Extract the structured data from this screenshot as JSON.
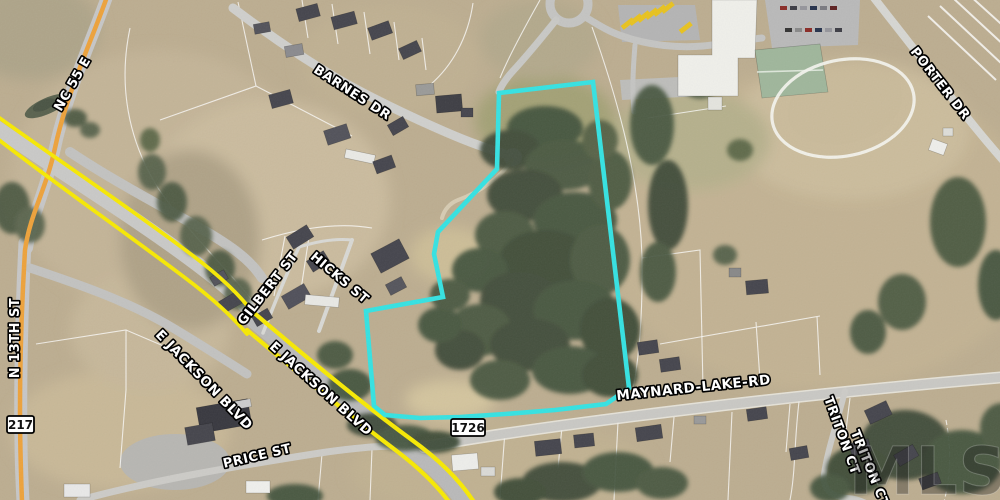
{
  "map": {
    "watermark": "MLS",
    "street_labels": [
      {
        "id": "nc-55-e",
        "text": "NC 55 E"
      },
      {
        "id": "barnes-dr",
        "text": "BARNES DR"
      },
      {
        "id": "porter-dr",
        "text": "PORTER DR"
      },
      {
        "id": "n-13th-st",
        "text": "N 13TH ST"
      },
      {
        "id": "gilbert-st",
        "text": "GILBERT ST"
      },
      {
        "id": "hicks-st",
        "text": "HICKS ST"
      },
      {
        "id": "e-jackson-blvd-1",
        "text": "E JACKSON BLVD"
      },
      {
        "id": "e-jackson-blvd-2",
        "text": "E JACKSON BLVD"
      },
      {
        "id": "price-st",
        "text": "PRICE ST"
      },
      {
        "id": "maynard-lake-rd",
        "text": "MAYNARD-LAKE-RD"
      },
      {
        "id": "triton-ct-1",
        "text": "TRITON CT"
      },
      {
        "id": "triton-ct-2",
        "text": "TRITON CT"
      }
    ],
    "route_shields": [
      {
        "id": "sr-217",
        "text": "217"
      },
      {
        "id": "sr-1726",
        "text": "1726"
      }
    ],
    "colors": {
      "property_boundary": "#35E2E2",
      "primary_route_highlight": "#F7E903",
      "secondary_route_highlight": "#EDA23B"
    }
  }
}
